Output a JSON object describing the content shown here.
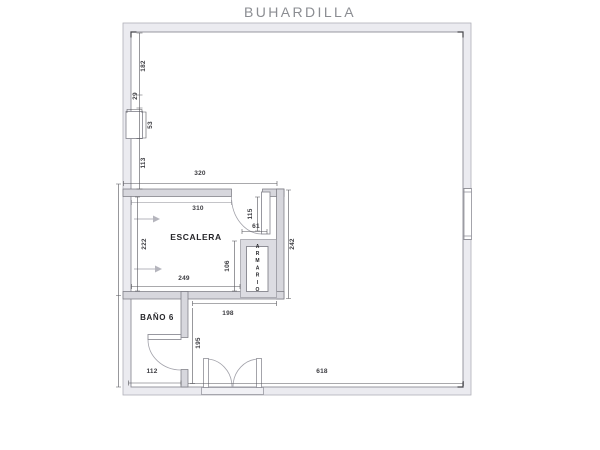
{
  "title": "BUHARDILLA",
  "rooms": {
    "escalera": "ESCALERA",
    "bano": "BAÑO 6",
    "armario": "ARMARIO"
  },
  "dims": {
    "left_182": "182",
    "left_29": "29",
    "window_53": "53",
    "left_113": "113",
    "top_320": "320",
    "inner_310": "310",
    "inner_222": "222",
    "inner_249": "249",
    "armario_106": "106",
    "door_115": "115",
    "door_61": "61",
    "right_242": "242",
    "hall_198": "198",
    "hall_195": "195",
    "bano_112": "112",
    "bottom_618": "618"
  },
  "colors": {
    "title_gray": "#8b8d92",
    "outer_wall_fill": "#ebebf0",
    "inner_wall_fill": "#d7d7dd",
    "dim_line": "#55555a",
    "dim_text": "#3c3c41",
    "outline_gray": "#8e8e96"
  }
}
